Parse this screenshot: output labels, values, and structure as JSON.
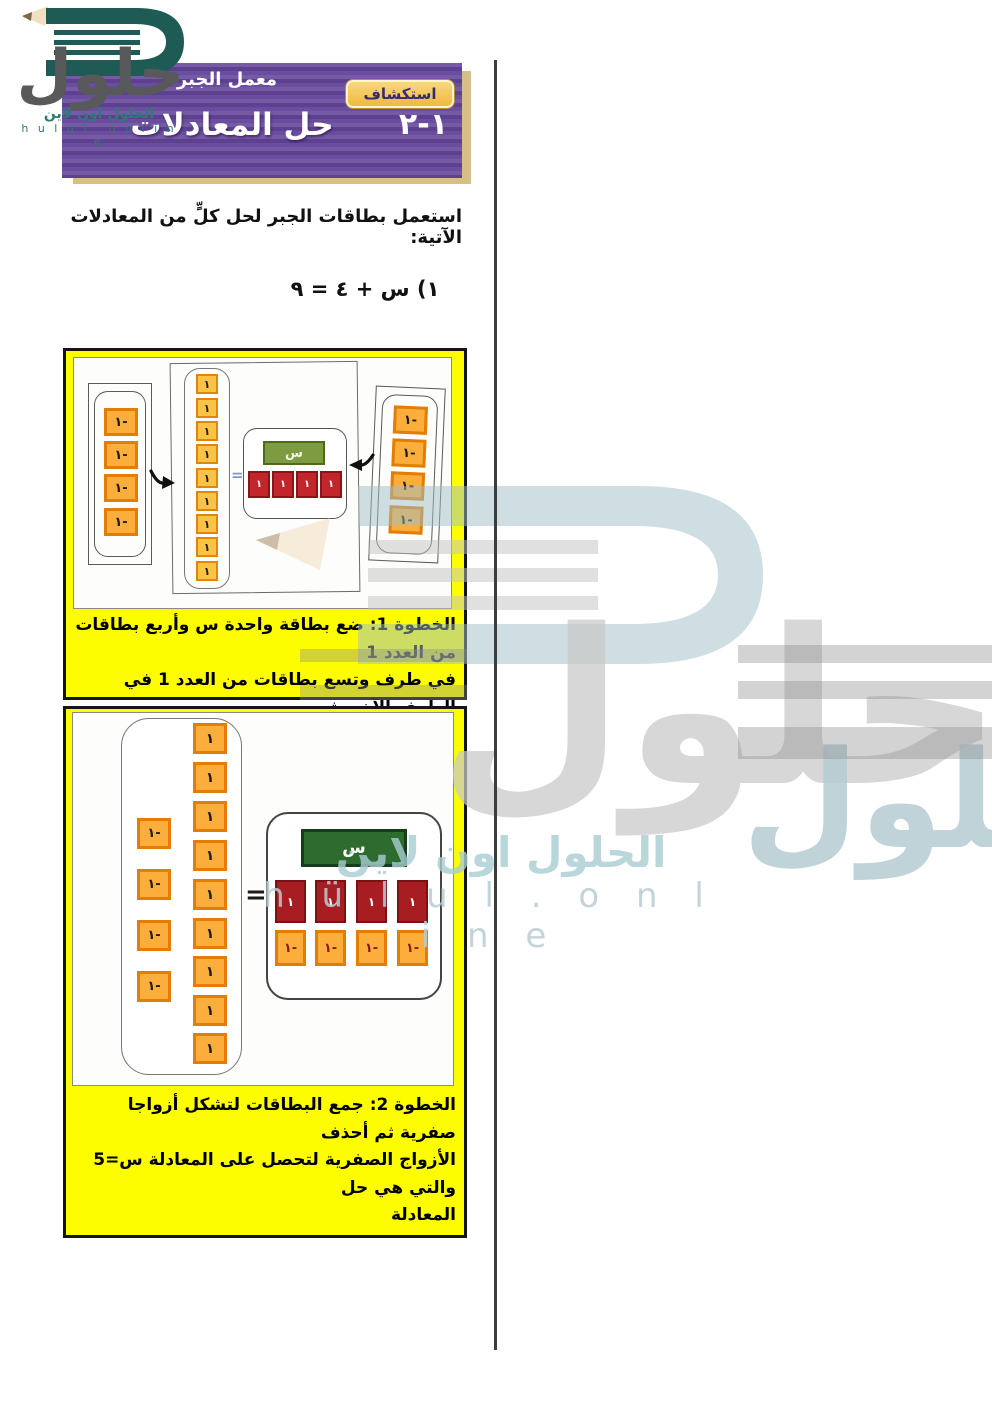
{
  "logo": {
    "brand": "حلول",
    "line_arabic": "الحلول اون لاين",
    "line_latin": "h u l u l . o n l i n e"
  },
  "header": {
    "lab_label": "معمل الجبر",
    "badge": "استكشاف",
    "lesson_number": "١-٢",
    "title": "حل المعادلات"
  },
  "intro_text": "استعمل بطاقات الجبر لحل كلٍّ من المعادلات الآتية:",
  "equation": "١) س + ٤ = ٩",
  "tile_labels": {
    "one": "١",
    "neg_one": "١-",
    "x": "س",
    "equals": "="
  },
  "steps": {
    "step1": {
      "lines": [
        "الخطوة 1: ضع بطاقة واحدة س وأربع بطاقات من العدد 1",
        "في طرف وتسع بطاقات من العدد 1 في الطرف الآخر، ثم",
        "أضف أربع بطاقات من العدد -1 إلى كلا الطرفين"
      ]
    },
    "step2": {
      "lines": [
        "الخطوة 2: جمع البطاقات لتشكل أزواجا صفرية ثم أحذف",
        "الأزواج الصفرية لتحصل على المعادلة س=5 والتي هي حل",
        "المعادلة"
      ]
    }
  },
  "watermark": {
    "brand_large": "حلول",
    "brand_blue": "الحلول",
    "line_arabic": "الحلول اون لاين",
    "line_latin": "h ü l u l . o n l i n e"
  },
  "colors": {
    "header_purple": "#6a4d9e",
    "header_gold_shadow": "#d8bf8a",
    "badge_gold": "#efb93e",
    "box_yellow": "#fdfd00",
    "tile_orange": "#fcae3c",
    "tile_orange_border": "#e27d05",
    "tile_red_diagram1": "#c2252b",
    "tile_red_diagram2": "#a81d22",
    "tile_green_diagram1": "#7d9b40",
    "tile_green_diagram2": "#2e6b2e",
    "watermark_blue": "#aec6cb",
    "watermark_gray": "#c9c9c9",
    "logo_teal": "#1e5b55"
  }
}
